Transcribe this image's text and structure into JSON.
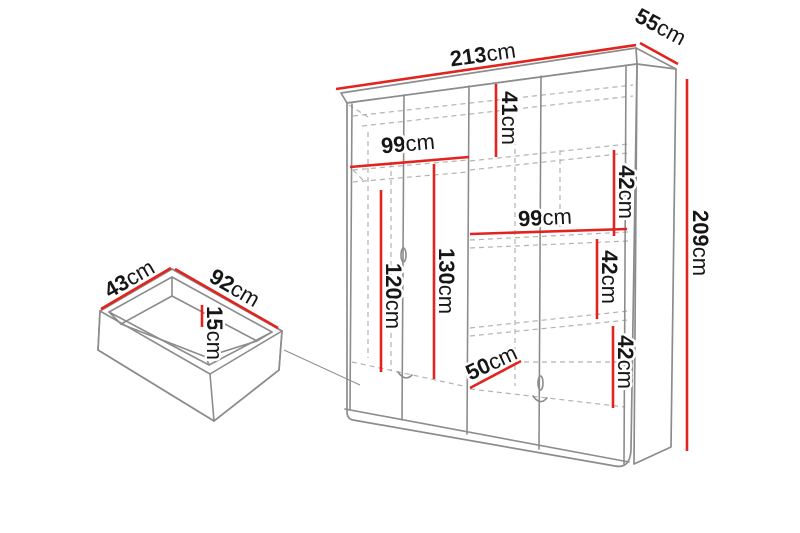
{
  "diagram": {
    "type": "furniture-dimension-diagram",
    "subject": "wardrobe with pull-out drawer"
  },
  "colors": {
    "dimension_red": "#e2231e",
    "outline_gray": "#8c8c8c",
    "dashed_gray": "#b2b2b2",
    "label_black": "#161616"
  },
  "wardrobe": {
    "width": {
      "value": "213",
      "unit": "cm"
    },
    "depth": {
      "value": "55",
      "unit": "cm"
    },
    "height": {
      "value": "209",
      "unit": "cm"
    },
    "top_shelf": {
      "value": "41",
      "unit": "cm"
    },
    "left_section_width": {
      "value": "99",
      "unit": "cm"
    },
    "right_section_width": {
      "value": "99",
      "unit": "cm"
    },
    "left_hanging_height": {
      "value": "120",
      "unit": "cm"
    },
    "middle_hanging_height": {
      "value": "130",
      "unit": "cm"
    },
    "shelf_gap_top": {
      "value": "42",
      "unit": "cm"
    },
    "shelf_gap_middle": {
      "value": "42",
      "unit": "cm"
    },
    "shelf_gap_bottom": {
      "value": "42",
      "unit": "cm"
    },
    "bottom_compartment_width": {
      "value": "50",
      "unit": "cm"
    }
  },
  "drawer": {
    "depth": {
      "value": "43",
      "unit": "cm"
    },
    "width": {
      "value": "92",
      "unit": "cm"
    },
    "height": {
      "value": "15",
      "unit": "cm"
    }
  }
}
